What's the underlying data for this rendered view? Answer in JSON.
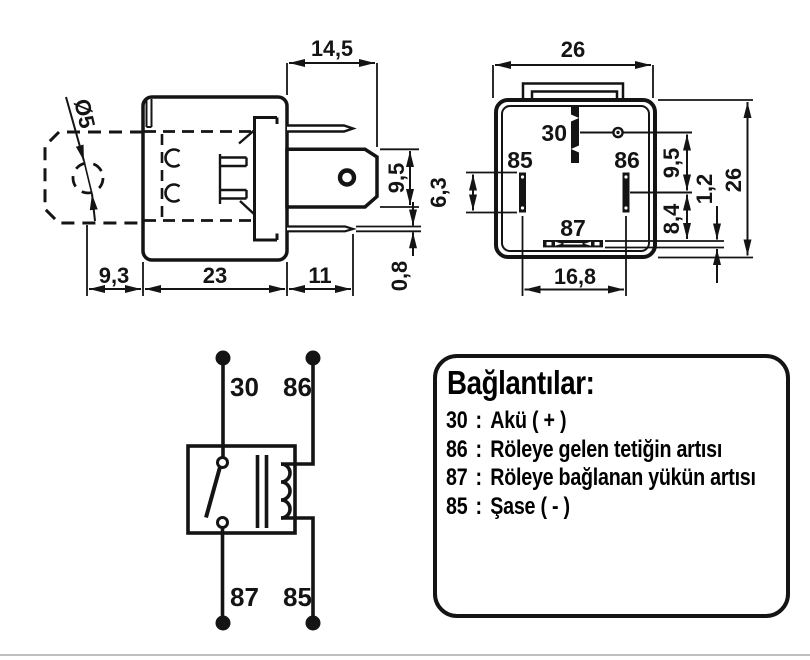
{
  "colors": {
    "ink": "#141414",
    "background": "#ffffff"
  },
  "side_view": {
    "dim_hole_diameter": "Ø5",
    "dim_pin_length": "14,5",
    "dim_blade_height": "9,5",
    "dim_tab_offset": "9,3",
    "dim_body_width": "23",
    "dim_pin_protrusion": "11",
    "dim_pin_thickness": "0,8"
  },
  "bottom_view": {
    "dim_width": "26",
    "dim_height": "26",
    "dim_pin85_length": "6,3",
    "dim_pin30_to_pins": "9,5",
    "dim_pins_to_pin87": "8,4",
    "dim_slot_thickness": "1,2",
    "dim_pin85_to_pin86": "16,8",
    "pin_30": "30",
    "pin_85": "85",
    "pin_86": "86",
    "pin_87": "87"
  },
  "schematic": {
    "pin_30": "30",
    "pin_86": "86",
    "pin_87": "87",
    "pin_85": "85"
  },
  "legend": {
    "title": "Bağlantılar:",
    "items": [
      {
        "pin": "30",
        "sep": ":",
        "desc": "Akü ( + )"
      },
      {
        "pin": "86",
        "sep": ":",
        "desc": "Röleye gelen tetiğin artısı"
      },
      {
        "pin": "87",
        "sep": ":",
        "desc": "Röleye bağlanan yükün artısı"
      },
      {
        "pin": "85",
        "sep": ":",
        "desc": "Şase ( - )"
      }
    ]
  }
}
